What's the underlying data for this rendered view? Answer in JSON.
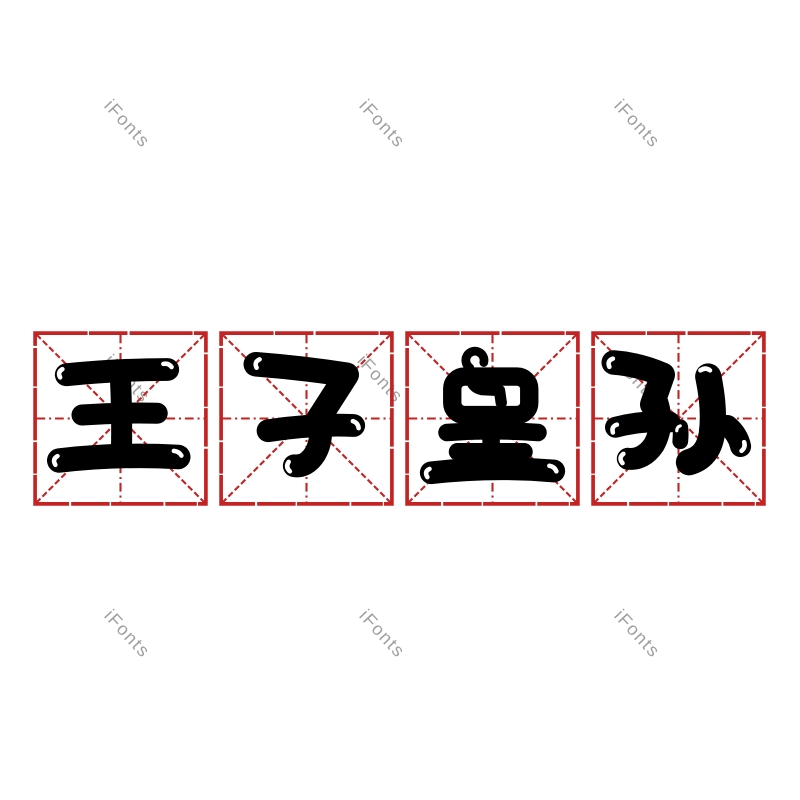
{
  "page": {
    "background": "#ffffff"
  },
  "phrase": {
    "text": "王子皇孙"
  },
  "grid": {
    "style": "mi-zi-ge",
    "line_color": "#c42323",
    "glyph_color": "#000000",
    "cells": [
      {
        "char": "王"
      },
      {
        "char": "子"
      },
      {
        "char": "皇"
      },
      {
        "char": "孙"
      }
    ]
  },
  "watermark": {
    "text": "iFonts",
    "color": "#8f8f8f",
    "rotation_deg": 47,
    "positions": [
      {
        "x": 127,
        "y": 124
      },
      {
        "x": 382,
        "y": 124
      },
      {
        "x": 637,
        "y": 124
      },
      {
        "x": 127,
        "y": 379
      },
      {
        "x": 380,
        "y": 379
      },
      {
        "x": 635,
        "y": 378
      },
      {
        "x": 127,
        "y": 634
      },
      {
        "x": 382,
        "y": 634
      },
      {
        "x": 637,
        "y": 634
      }
    ]
  }
}
